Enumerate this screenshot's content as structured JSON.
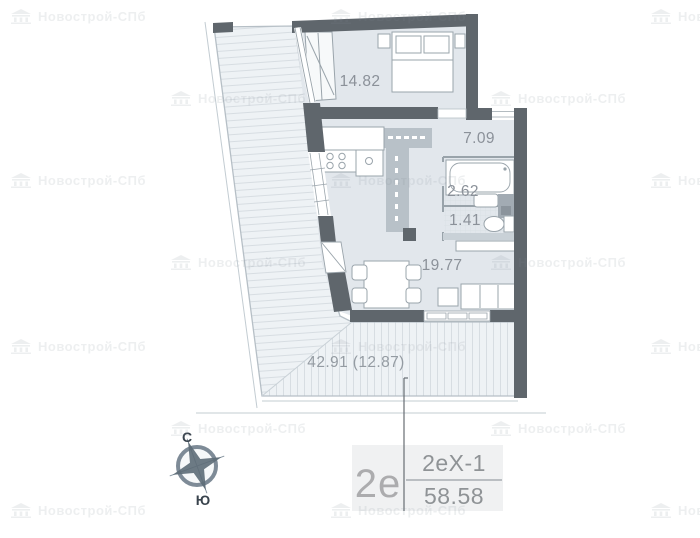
{
  "plan": {
    "rooms": [
      {
        "name": "bedroom",
        "area": "14.82"
      },
      {
        "name": "hallway",
        "area": "7.09"
      },
      {
        "name": "bathroom",
        "area": "2.62"
      },
      {
        "name": "wc",
        "area": "1.41"
      },
      {
        "name": "living-kitchen",
        "area": "19.77"
      }
    ],
    "terrace": {
      "area_label": "42.91 (12.87)"
    }
  },
  "unit": {
    "type": "2е",
    "plan_code": "2еХ-1",
    "total_area": "58.58"
  },
  "compass": {
    "north": "С",
    "south": "Ю"
  },
  "watermark": {
    "text": "Новострой-СПб",
    "positions": [
      {
        "x": 10,
        "y": 8
      },
      {
        "x": 330,
        "y": 8
      },
      {
        "x": 650,
        "y": 8
      },
      {
        "x": 170,
        "y": 90
      },
      {
        "x": 490,
        "y": 90
      },
      {
        "x": 10,
        "y": 172
      },
      {
        "x": 330,
        "y": 172
      },
      {
        "x": 650,
        "y": 172
      },
      {
        "x": 170,
        "y": 254
      },
      {
        "x": 490,
        "y": 254
      },
      {
        "x": 10,
        "y": 338
      },
      {
        "x": 330,
        "y": 338
      },
      {
        "x": 650,
        "y": 338
      },
      {
        "x": 170,
        "y": 420
      },
      {
        "x": 490,
        "y": 420
      },
      {
        "x": 10,
        "y": 502
      },
      {
        "x": 330,
        "y": 502
      },
      {
        "x": 650,
        "y": 502
      }
    ]
  },
  "colors": {
    "wall": "#5f666c",
    "floor": "#e2e7ec",
    "terrace_fill": "#eef2f5",
    "hatch_line": "#d7dde2",
    "label_text": "#8b9199",
    "card_bg": "#f0f1f2",
    "compass": "#5d6b77"
  }
}
